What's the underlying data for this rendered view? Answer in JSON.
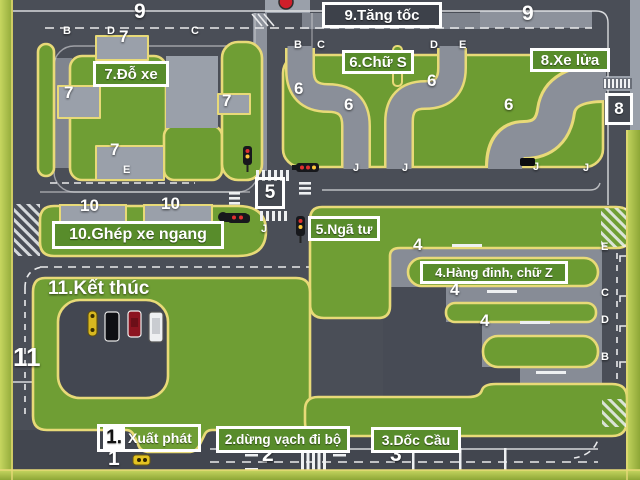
{
  "stations": {
    "s1_prefix": "1.",
    "s1_name": "Xuất phát",
    "s2": "2.dừng vạch đi bộ",
    "s3": "3.Dốc Cầu",
    "s4": "4.Hàng đinh, chữ Z",
    "s5": "5.Ngã tư",
    "s6": "6.Chữ S",
    "s7": "7.Đỗ xe",
    "s8": "8.Xe lửa",
    "s9": "9.Tăng tốc",
    "s10": "10.Ghép xe ngang",
    "s11": "11.Kết thúc"
  },
  "signs": {
    "intersection": "5",
    "railway": "8"
  },
  "marks": [
    {
      "t": "9"
    },
    {
      "t": "9"
    },
    {
      "t": "7"
    },
    {
      "t": "7"
    },
    {
      "t": "7"
    },
    {
      "t": "7"
    },
    {
      "t": "6"
    },
    {
      "t": "6"
    },
    {
      "t": "6"
    },
    {
      "t": "6"
    },
    {
      "t": "10"
    },
    {
      "t": "10"
    },
    {
      "t": "4"
    },
    {
      "t": "4"
    },
    {
      "t": "4"
    },
    {
      "t": "11"
    },
    {
      "t": "1"
    },
    {
      "t": "2"
    },
    {
      "t": "3"
    },
    {
      "t": "B"
    },
    {
      "t": "D"
    },
    {
      "t": "C"
    },
    {
      "t": "E"
    },
    {
      "t": "B"
    },
    {
      "t": "C"
    },
    {
      "t": "D"
    },
    {
      "t": "E"
    },
    {
      "t": "J"
    },
    {
      "t": "J"
    },
    {
      "t": "J"
    },
    {
      "t": "J"
    },
    {
      "t": "E"
    },
    {
      "t": "C"
    },
    {
      "t": "D"
    },
    {
      "t": "B"
    },
    {
      "t": "J"
    }
  ],
  "icons": {
    "traffic_light": "traffic-light-icon",
    "car": "car-icon",
    "railway_crossing": "railway-crossing-icon",
    "signal_ball": "signal-ball-icon"
  },
  "colors": {
    "grass": "#6d9c32",
    "grass_border": "#e8da78",
    "road": "#4a4e57",
    "road_light": "#9aa0aa",
    "label_green": "#588c2b",
    "frame_green": "#a9bf46",
    "signal_red": "#cf1f2a"
  }
}
